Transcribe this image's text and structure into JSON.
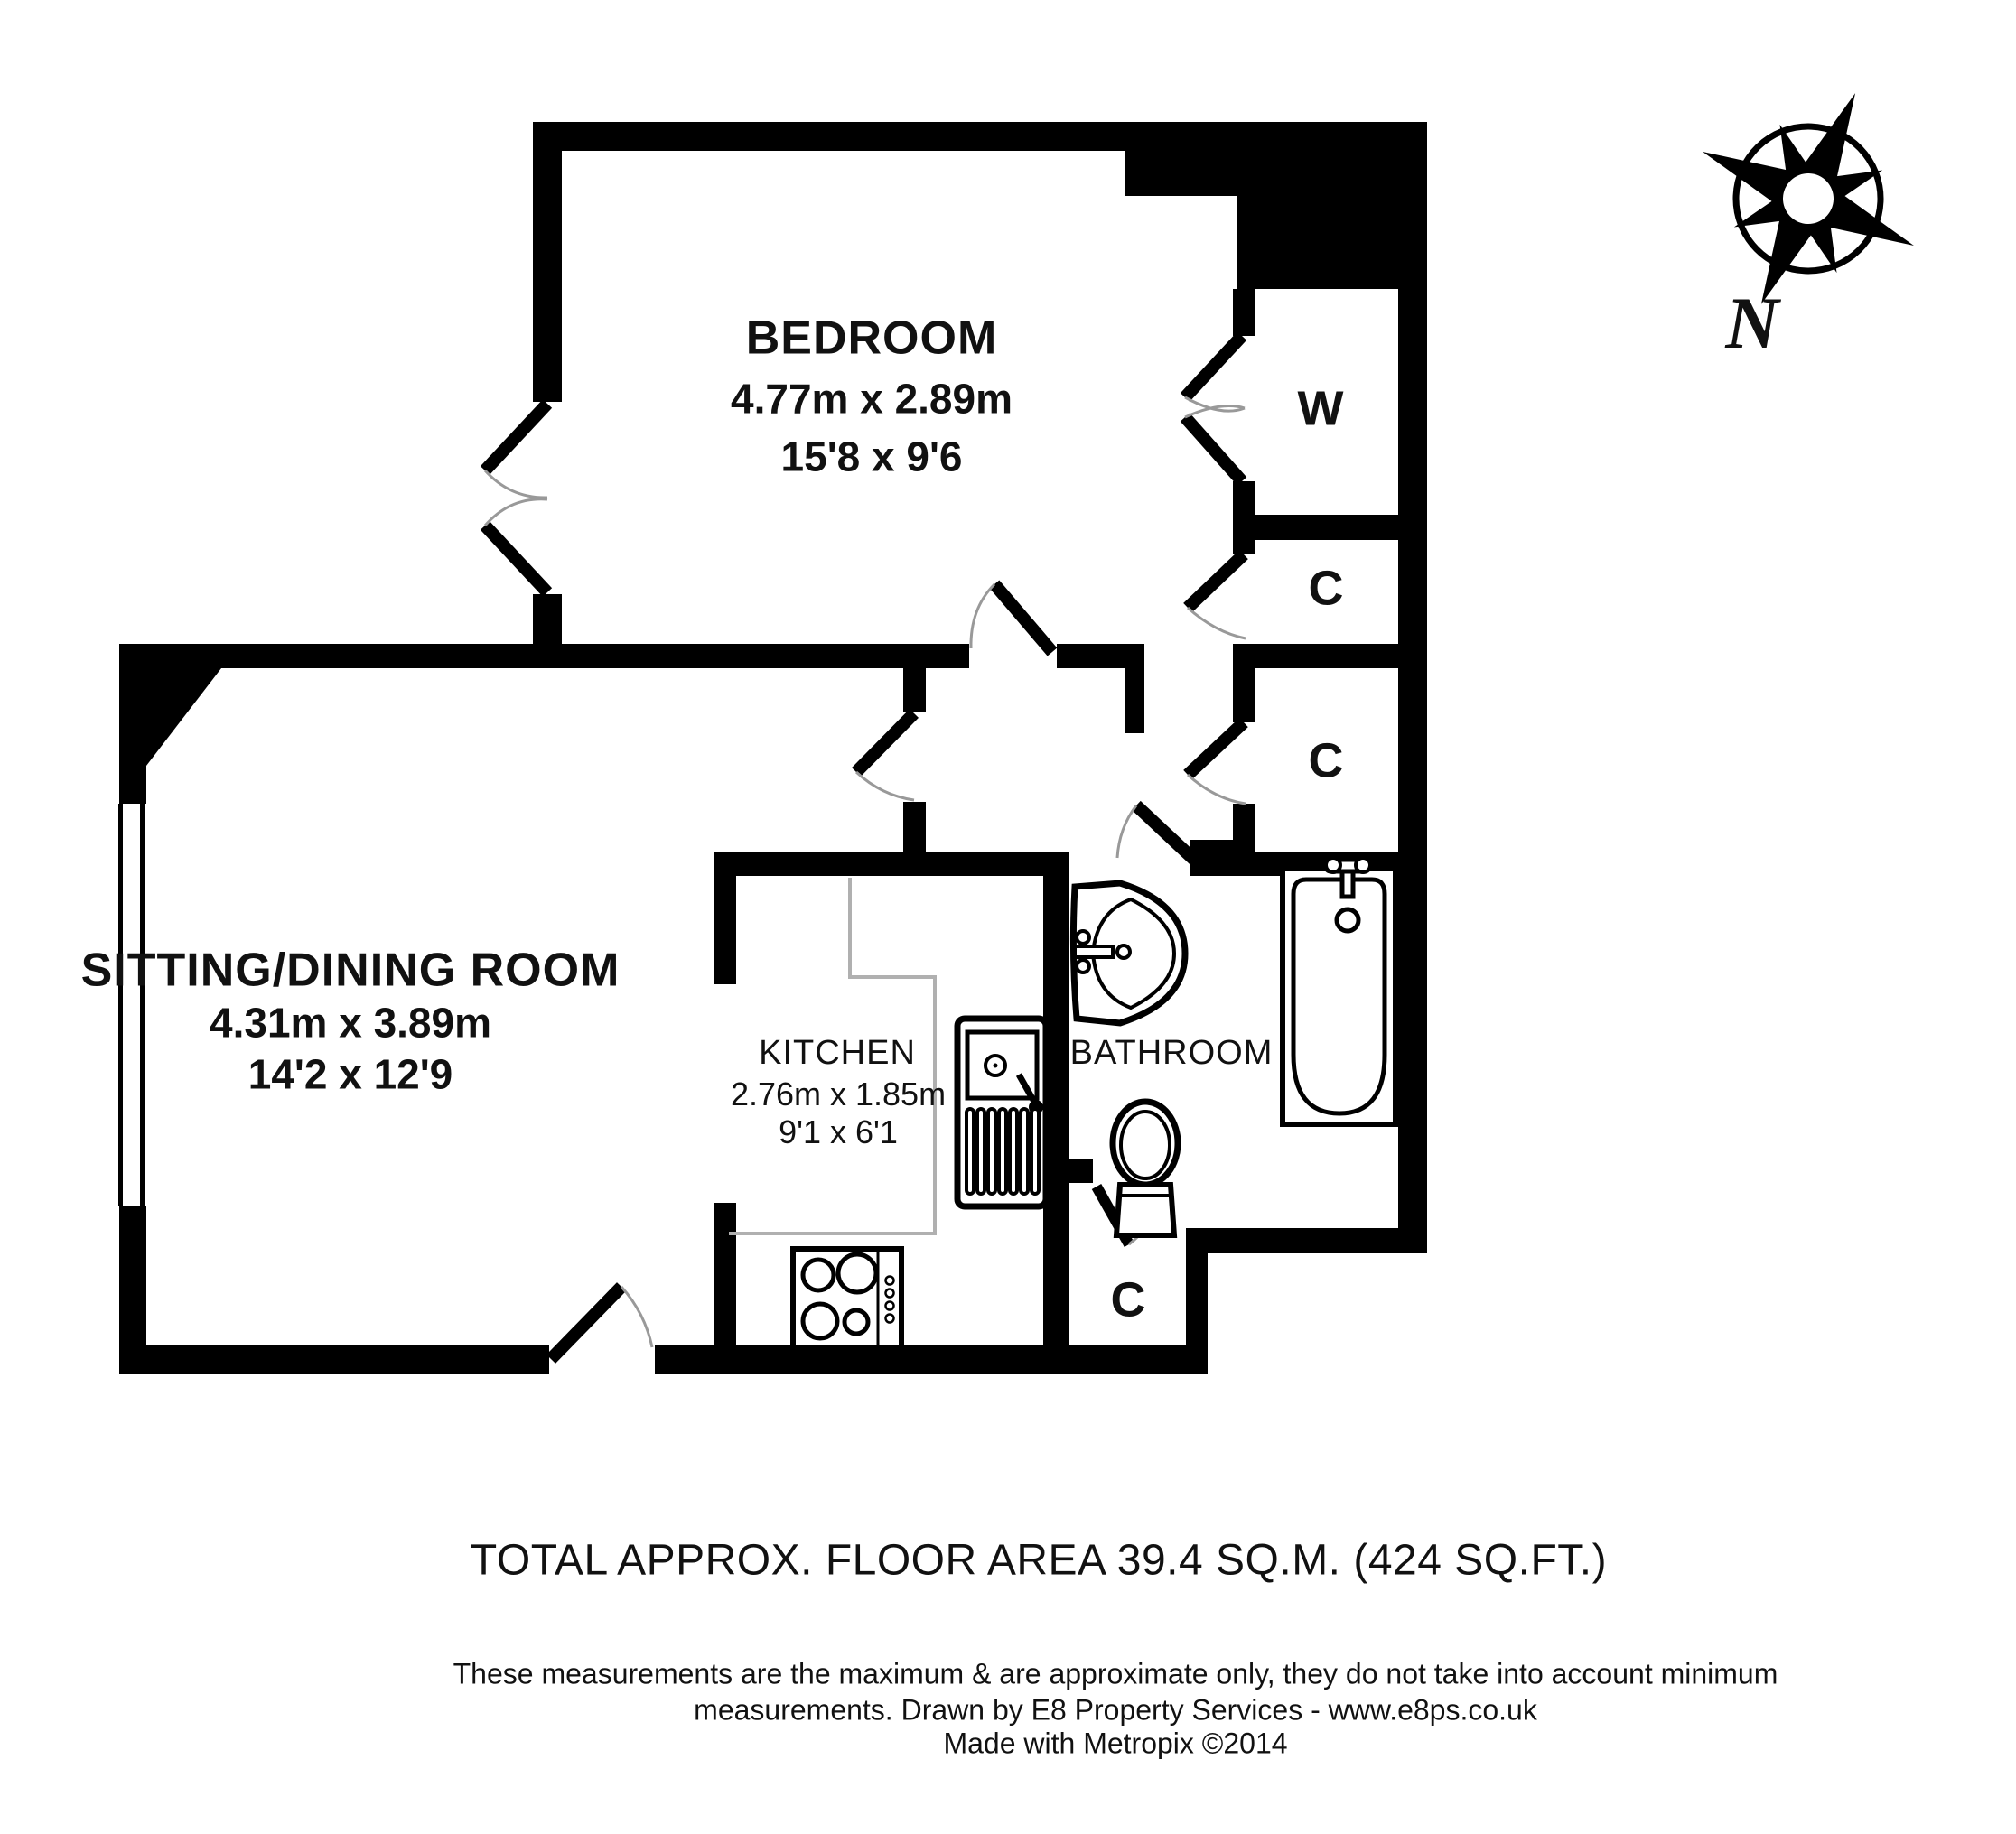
{
  "rooms": {
    "bedroom": {
      "name": "BEDROOM",
      "dim_metric": "4.77m x 2.89m",
      "dim_imperial": "15'8 x 9'6"
    },
    "sitting": {
      "name": "SITTING/DINING ROOM",
      "dim_metric": "4.31m x 3.89m",
      "dim_imperial": "14'2 x 12'9"
    },
    "kitchen": {
      "name": "KITCHEN",
      "dim_metric": "2.76m x 1.85m",
      "dim_imperial": "9'1 x 6'1"
    },
    "bathroom": {
      "name": "BATHROOM"
    }
  },
  "closets": {
    "wardrobe_label": "W",
    "hall_closet_upper_label": "C",
    "hall_closet_lower_label": "C",
    "bathroom_closet_label": "C"
  },
  "compass": {
    "north_label": "N"
  },
  "footer": {
    "total_area": "TOTAL APPROX. FLOOR AREA 39.4 SQ.M. (424 SQ.FT.)",
    "disclaimer_line1": "These measurements are the maximum & are approximate only, they do not take into account minimum",
    "disclaimer_line2": "measurements. Drawn by E8 Property Services - www.e8ps.co.uk",
    "credit": "Made with Metropix ©2014"
  },
  "colors": {
    "wall": "#000000",
    "door_arc": "#999999",
    "counter_outline": "#b0b0b0",
    "background": "#ffffff",
    "text": "#111111"
  }
}
